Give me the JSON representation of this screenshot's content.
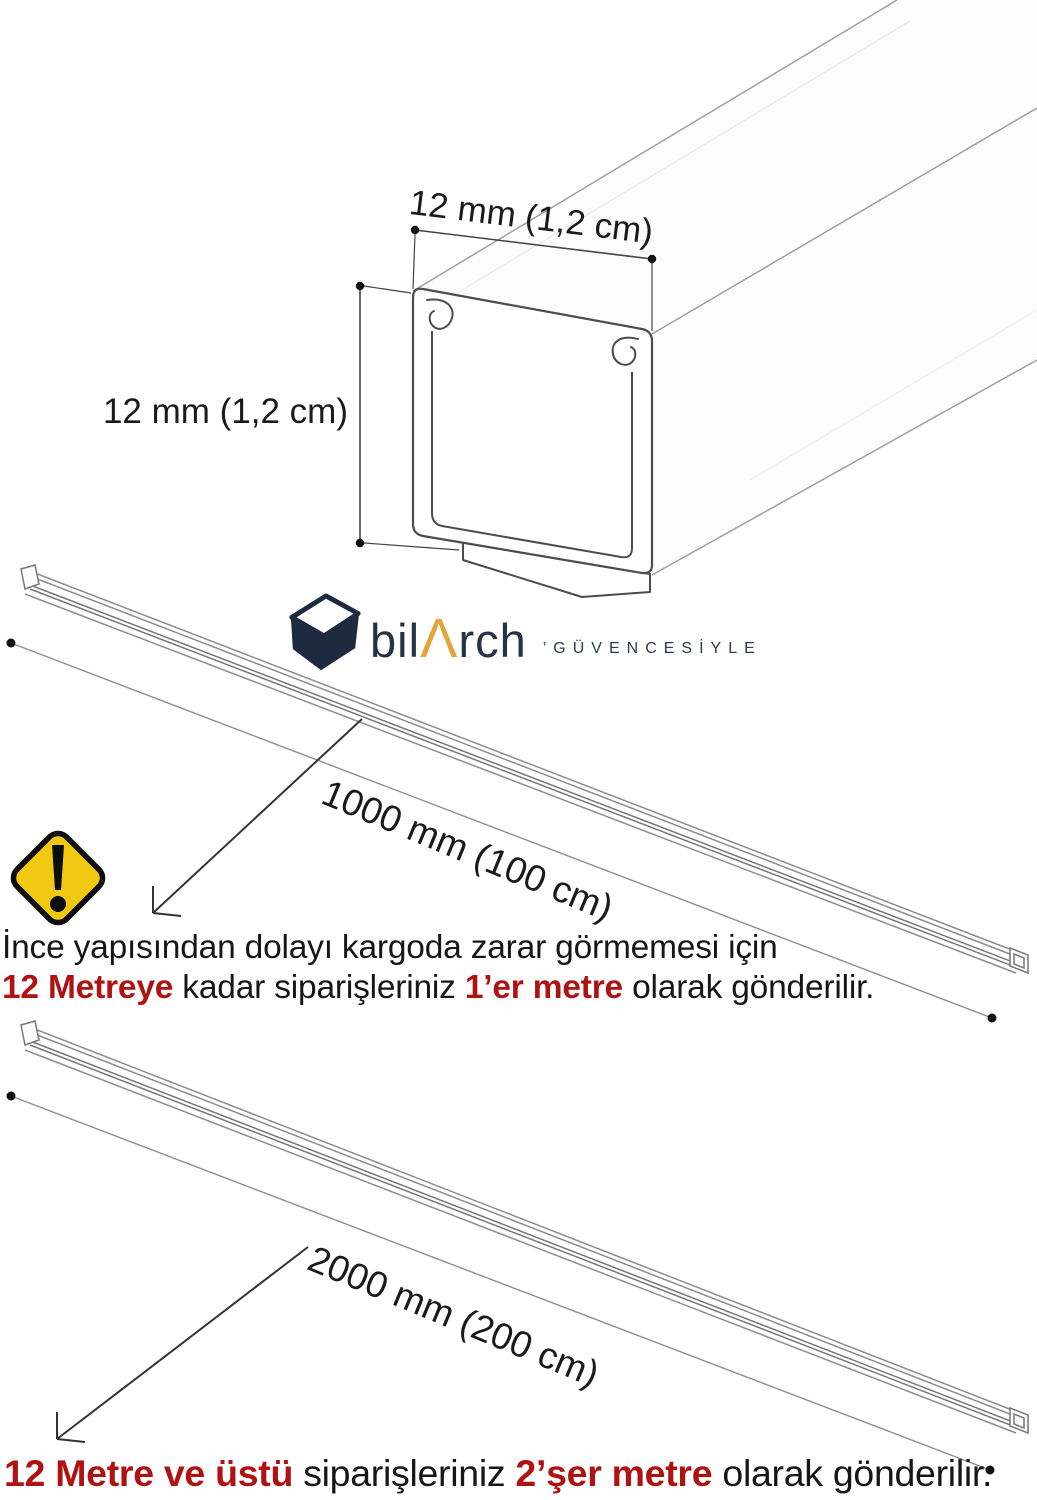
{
  "diagram": {
    "top_width_label": "12 mm (1,2 cm)",
    "left_height_label": "12 mm (1,2 cm)",
    "bar1_label": "1000 mm (100 cm)",
    "bar2_label": "2000 mm (200 cm)"
  },
  "logo": {
    "word_bil": "bil",
    "word_a": "Λ",
    "word_rch": "rch",
    "tagline": "’GÜVENCESİYLE"
  },
  "shipping_notice_1": {
    "line1": "İnce yapısından dolayı kargoda zarar görmemesi için",
    "highlight1": "12 Metreye",
    "middle": " kadar siparişleriniz ",
    "highlight2": "1’er metre",
    "end": " olarak gönderilir."
  },
  "shipping_notice_2": {
    "highlight1": "12 Metre ve üstü",
    "middle": " siparişleriniz ",
    "highlight2": "2’şer metre",
    "end": " olarak gönderilir."
  },
  "colors": {
    "highlight_red": "#b01212",
    "text_black": "#161616",
    "warning_yellow": "#f2c912",
    "logo_navy": "#1d2a40",
    "logo_accent_orange": "#e3a43c"
  },
  "icons": {
    "warning": "warning-diamond-icon",
    "logo_cube": "cube-logo-icon"
  }
}
